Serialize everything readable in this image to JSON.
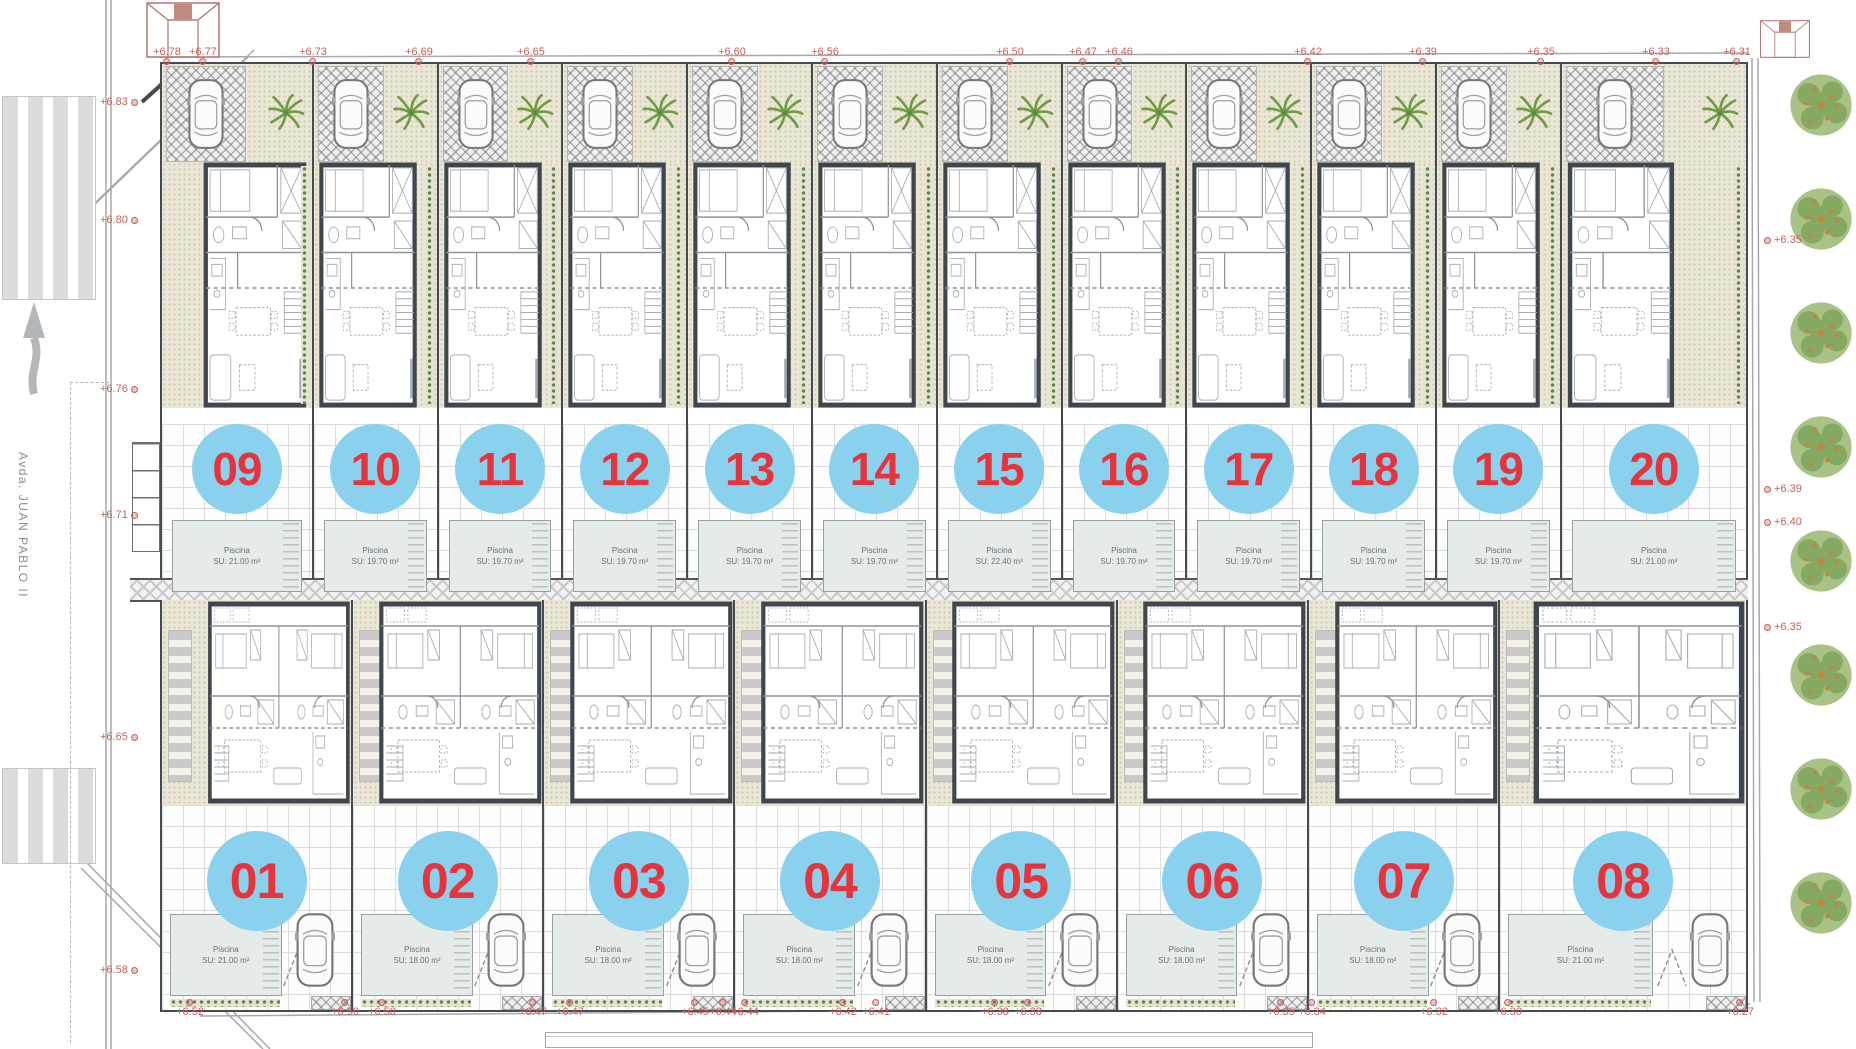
{
  "street": {
    "name": "Avda. JUAN PABLO II"
  },
  "pool_title": "Piscina",
  "units_top": [
    {
      "number": "09",
      "pool_area": "SU: 21.00 m²"
    },
    {
      "number": "10",
      "pool_area": "SU: 19.70 m²"
    },
    {
      "number": "11",
      "pool_area": "SU: 19.70 m²"
    },
    {
      "number": "12",
      "pool_area": "SU: 19.70 m²"
    },
    {
      "number": "13",
      "pool_area": "SU: 19.70 m²"
    },
    {
      "number": "14",
      "pool_area": "SU: 19.70 m²"
    },
    {
      "number": "15",
      "pool_area": "SU: 22.40 m²"
    },
    {
      "number": "16",
      "pool_area": "SU: 19.70 m²"
    },
    {
      "number": "17",
      "pool_area": "SU: 19.70 m²"
    },
    {
      "number": "18",
      "pool_area": "SU: 19.70 m²"
    },
    {
      "number": "19",
      "pool_area": "SU: 19.70 m²"
    },
    {
      "number": "20",
      "pool_area": "SU: 21.00 m²"
    }
  ],
  "units_bottom": [
    {
      "number": "01",
      "pool_area": "SU: 21.00 m²"
    },
    {
      "number": "02",
      "pool_area": "SU: 18.00 m²"
    },
    {
      "number": "03",
      "pool_area": "SU: 18.00 m²"
    },
    {
      "number": "04",
      "pool_area": "SU: 18.00 m²"
    },
    {
      "number": "05",
      "pool_area": "SU: 18.00 m²"
    },
    {
      "number": "06",
      "pool_area": "SU: 18.00 m²"
    },
    {
      "number": "07",
      "pool_area": "SU: 18.00 m²"
    },
    {
      "number": "08",
      "pool_area": "SU: 21.00 m²"
    }
  ],
  "markers_top": [
    {
      "label": "+6.78",
      "x": 167
    },
    {
      "label": "+6.77",
      "x": 203
    },
    {
      "label": "+6.73",
      "x": 313
    },
    {
      "label": "+6.69",
      "x": 419
    },
    {
      "label": "+6.65",
      "x": 531
    },
    {
      "label": "+6.60",
      "x": 732
    },
    {
      "label": "+6.56",
      "x": 825
    },
    {
      "label": "+6.50",
      "x": 1010
    },
    {
      "label": "+6.47",
      "x": 1083
    },
    {
      "label": "+6.46",
      "x": 1119
    },
    {
      "label": "+6.42",
      "x": 1308
    },
    {
      "label": "+6.39",
      "x": 1423
    },
    {
      "label": "+6.35",
      "x": 1541
    },
    {
      "label": "+6.33",
      "x": 1656
    },
    {
      "label": "+6.31",
      "x": 1737
    }
  ],
  "markers_bottom": [
    {
      "label": "+6.52",
      "x": 190
    },
    {
      "label": "+6.50",
      "x": 345
    },
    {
      "label": "+6.50",
      "x": 382
    },
    {
      "label": "+6.47",
      "x": 533
    },
    {
      "label": "+6.47",
      "x": 570
    },
    {
      "label": "+6.45",
      "x": 695
    },
    {
      "label": "+6.44",
      "x": 723
    },
    {
      "label": "+6.44",
      "x": 745
    },
    {
      "label": "+6.42",
      "x": 843
    },
    {
      "label": "+6.41",
      "x": 876
    },
    {
      "label": "+6.38",
      "x": 995
    },
    {
      "label": "+6.38",
      "x": 1028
    },
    {
      "label": "+6.35",
      "x": 1281
    },
    {
      "label": "+6.34",
      "x": 1312
    },
    {
      "label": "+6.32",
      "x": 1434
    },
    {
      "label": "+6.30",
      "x": 1508
    },
    {
      "label": "+6.27",
      "x": 1740
    }
  ],
  "markers_left": [
    {
      "label": "+6.83",
      "y": 96
    },
    {
      "label": "+6.80",
      "y": 214
    },
    {
      "label": "+6.76",
      "y": 383
    },
    {
      "label": "+6.71",
      "y": 509
    },
    {
      "label": "+6.65",
      "y": 731
    },
    {
      "label": "+6.58",
      "y": 964
    }
  ],
  "markers_right": [
    {
      "label": "+6.35",
      "y": 234
    },
    {
      "label": "+6.39",
      "y": 483
    },
    {
      "label": "+6.40",
      "y": 516
    },
    {
      "label": "+6.35",
      "y": 621
    }
  ],
  "colors": {
    "circle": "#8ad1ee",
    "num": "#e6333c",
    "marker": "#c4615c",
    "pool": "#e4ebe8",
    "wall": "#454b52",
    "green": "#6f9c43"
  }
}
